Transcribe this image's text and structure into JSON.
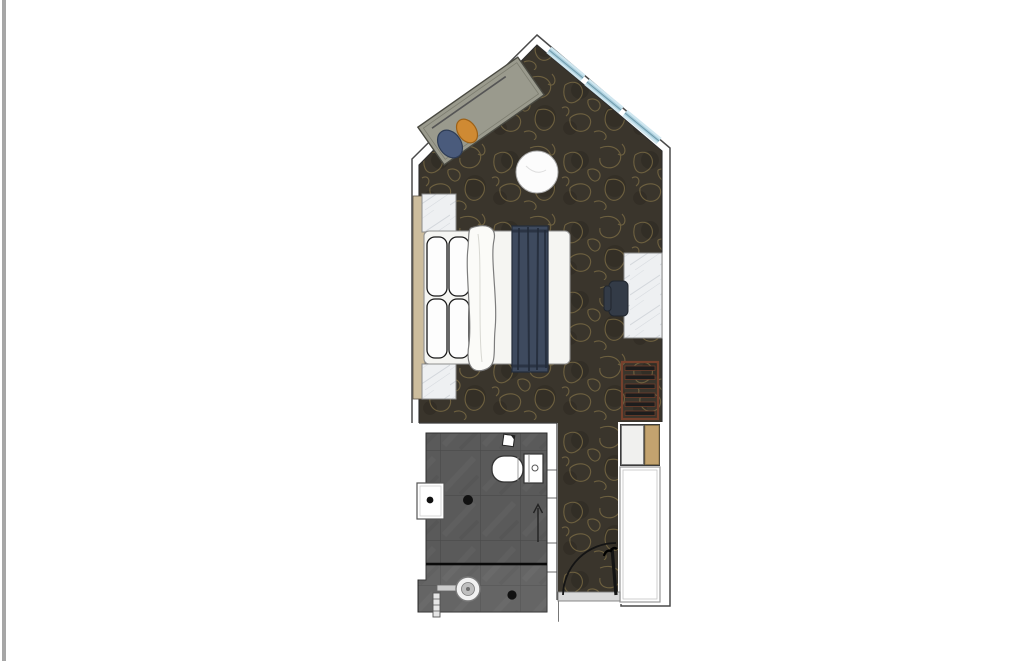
{
  "meta": {
    "description": "Top-down architectural floor plan of a hotel guest room with angled window wall, bedroom, bathroom, closet and entry",
    "plan_type": "hotel-room-floor-plan",
    "visible_text": ""
  },
  "colors": {
    "edge_strip": "#a6a6a6",
    "background": "#ffffff",
    "wall_fill": "#ffffff",
    "wall_stroke": "#4a4a4a",
    "inner_line": "#2e2e2e",
    "carpet_base": "#3a352c",
    "carpet_swirl": "#8d7b4a",
    "carpet_blotch": "#2c2820",
    "tile_base": "#5a5a5a",
    "tile_line": "#4a4a4a",
    "window_glass": "#cfe6ef",
    "window_mid": "#a9cedd",
    "window_frame": "#6f98a8",
    "daybed_body": "#9a9a8d",
    "daybed_edge": "#4a4a42",
    "cushion_blue": "#4a5b7c",
    "cushion_blue_edge": "#2e3c55",
    "cushion_orange": "#cf8a33",
    "cushion_orange_edge": "#9c6117",
    "round_table": "#fcfcfc",
    "headboard_tan": "#cdbd9d",
    "marble_light": "#eef0f2",
    "marble_vein": "#d3d7dc",
    "mattress": "#f5f5f2",
    "pillow": "#fdfdfd",
    "pillow_line": "#1a1a1a",
    "duvet": "#fbfbf8",
    "runner_navy": "#3e4a5e",
    "runner_streak": "#232c3a",
    "chair_dark": "#333b47",
    "rack_frame": "#76402c",
    "rack_slat": "#1d1d1d",
    "minibar_left": "#f0f0ee",
    "minibar_right": "#c3a36f",
    "closet_fill": "#ffffff",
    "closet_line": "#999999",
    "fixture_white": "#ffffff",
    "fixture_line": "#333333",
    "drain_dark": "#111111",
    "screen_line": "#0a0a0a",
    "threshold": "#d9d9d9",
    "door_arc": "#141414"
  },
  "furniture": {
    "daybed": "daybed with two cushions",
    "round_table": "round side table",
    "bed": "double bed with pillows, duvet and navy runner",
    "headboard": "headboard panel",
    "nightstand_top": "nightstand",
    "nightstand_bottom": "nightstand",
    "desk": "wall-mounted marble desk",
    "desk_chair": "desk chair",
    "luggage_rack": "slatted luggage rack",
    "minibar": "minibar cabinet",
    "closet": "wardrobe closet",
    "toilet": "toilet",
    "wash_basin": "wall-hung wash basin",
    "shower": "walk-in shower with drain",
    "windows": "glazed corner window wall",
    "entry_door": "entry door with swing arc"
  }
}
